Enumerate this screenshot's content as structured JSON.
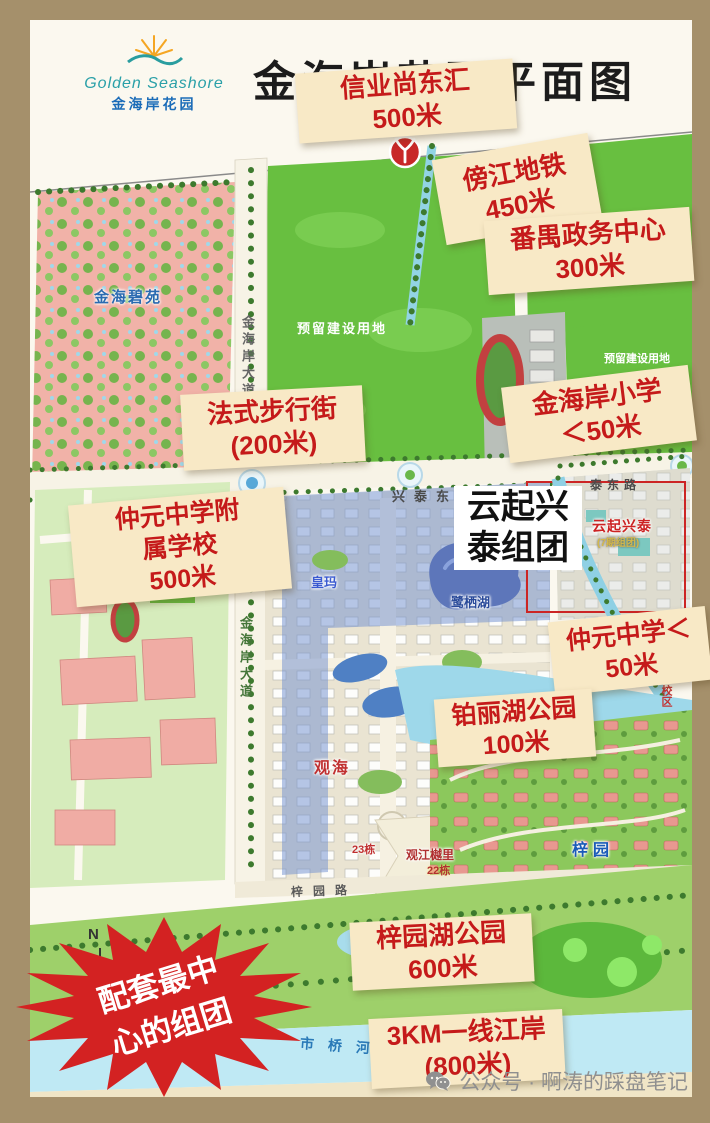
{
  "header": {
    "title": "金海岸花园平面图",
    "logo_en": "Golden Seashore",
    "logo_cn": "金海岸花园"
  },
  "annotations": [
    {
      "line1": "信业尚东汇",
      "line2": "500米"
    },
    {
      "line1": "傍江地铁",
      "line2": "450米"
    },
    {
      "line1": "番禺政务中心",
      "line2": "300米"
    },
    {
      "line1": "金海岸小学",
      "line2": "＜50米"
    },
    {
      "line1": "法式步行街",
      "line2": "(200米)"
    },
    {
      "line1": "仲元中学附",
      "line2": "属学校",
      "line3": "500米"
    },
    {
      "line1": "仲元中学＜",
      "line2": "50米"
    },
    {
      "line1": "铂丽湖公园",
      "line2": "100米"
    },
    {
      "line1": "梓园湖公园",
      "line2": "600米"
    },
    {
      "line1": "3KM一线江岸",
      "line2": "(800米)"
    }
  ],
  "cluster_callout": {
    "line1": "云起兴",
    "line2": "泰组团"
  },
  "starburst": {
    "line1": "配套最中",
    "line2": "心的组团"
  },
  "map_labels": {
    "reserved_land_center": "预留建设用地",
    "development_land": "发展用地",
    "reserved_land_right": "预留建设用地",
    "jinhai_biyuan": "金海碧苑",
    "road_jinhaian_avenue_top": "金海岸大道",
    "road_jinhaian_avenue_bottom": "金海岸大道",
    "road_xingtai_east": "兴泰东路",
    "road_taidong": "泰东路",
    "road_ziyuan": "梓园路",
    "yunqi_xingtai": "云起兴泰",
    "yunqi_xingtai_sub": "(7期组团)",
    "huangma": "皇玛",
    "lake_luqi": "鹭栖湖",
    "guanhai": "观海",
    "building_23": "23栋",
    "guanjiang_yueli": "观江樾里",
    "building_22": "22栋",
    "ziyuan_villas": "梓园",
    "campus_side": "一校区",
    "shiqiao_river": "市桥河",
    "compass_n": "N"
  },
  "watermark": {
    "source": "公众号 · 啊涛的踩盘笔记"
  },
  "colors": {
    "frame": "#a5906b",
    "accent_red": "#c51a1a",
    "label_bg": "#f8e9c6",
    "starburst_red": "#d32222",
    "field_green": "#68bf40",
    "water_blue": "#9ed8ea"
  }
}
